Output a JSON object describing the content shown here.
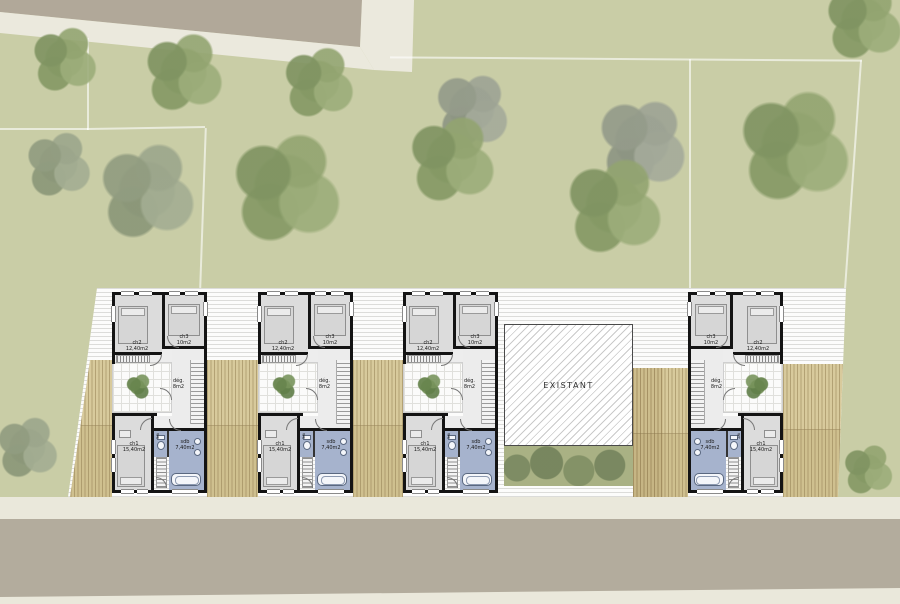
{
  "site": {
    "existing_building_label": "EXISTANT",
    "colors": {
      "grass": "#c9cda6",
      "road": "#b2ab9c",
      "path": "#ebe9dd",
      "terrace_white": "#fcfcfb",
      "deck_wood": "#d8ca9c",
      "deck_wood_dark": "#cfc08f",
      "wall": "#141414",
      "room_grey": "#dcdcdc",
      "wet_room_blue": "#a6b3cd",
      "hedge_green": "#a9b184",
      "tree_green": "#8ea06f"
    }
  },
  "unit_labels": {
    "ch1_name": "ch1",
    "ch1_area": "15,40m2",
    "ch2_name": "ch2",
    "ch2_area": "12,40m2",
    "ch3_name": "ch3",
    "ch3_area": "10m2",
    "deg_name": "dég.",
    "deg_area": "8m2",
    "sdb_name": "sdb",
    "sdb_area": "7,40m2",
    "wc_name": "wc"
  }
}
